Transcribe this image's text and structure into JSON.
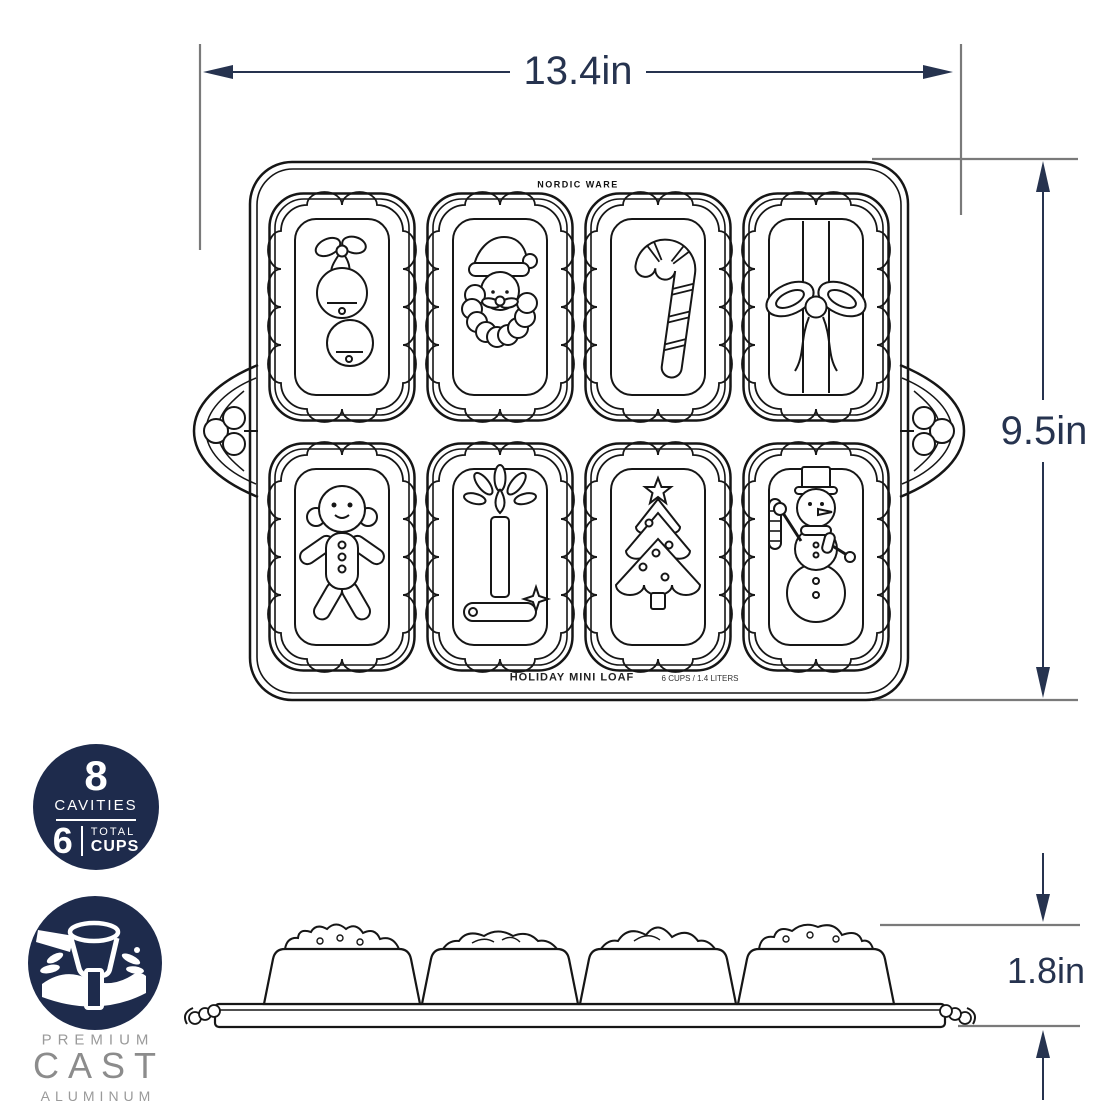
{
  "dimensions": {
    "width": "13.4in",
    "height": "9.5in",
    "depth": "1.8in"
  },
  "pan": {
    "brand": "NORDIC WARE",
    "product_label": "HOLIDAY MINI LOAF",
    "capacity_label": "6 CUPS / 1.4 LITERS",
    "cavity_icons": [
      "jingle-bells",
      "santa",
      "candy-cane",
      "gift-bow",
      "gingerbread-man",
      "candle",
      "christmas-tree",
      "snowman"
    ]
  },
  "badges": {
    "capacity": {
      "cavities_value": "8",
      "cavities_label": "CAVITIES",
      "cups_value": "6",
      "cups_label_line1": "TOTAL",
      "cups_label_line2": "CUPS"
    },
    "material": {
      "line1": "PREMIUM",
      "line2": "CAST",
      "line3": "ALUMINUM"
    }
  },
  "colors": {
    "badge_navy": "#1e2b4c",
    "dimension_ink": "#26334f",
    "extension_line_gray": "#7a7a7a",
    "drawing_ink": "#161616",
    "material_text_gray": "#9a9a9a"
  }
}
